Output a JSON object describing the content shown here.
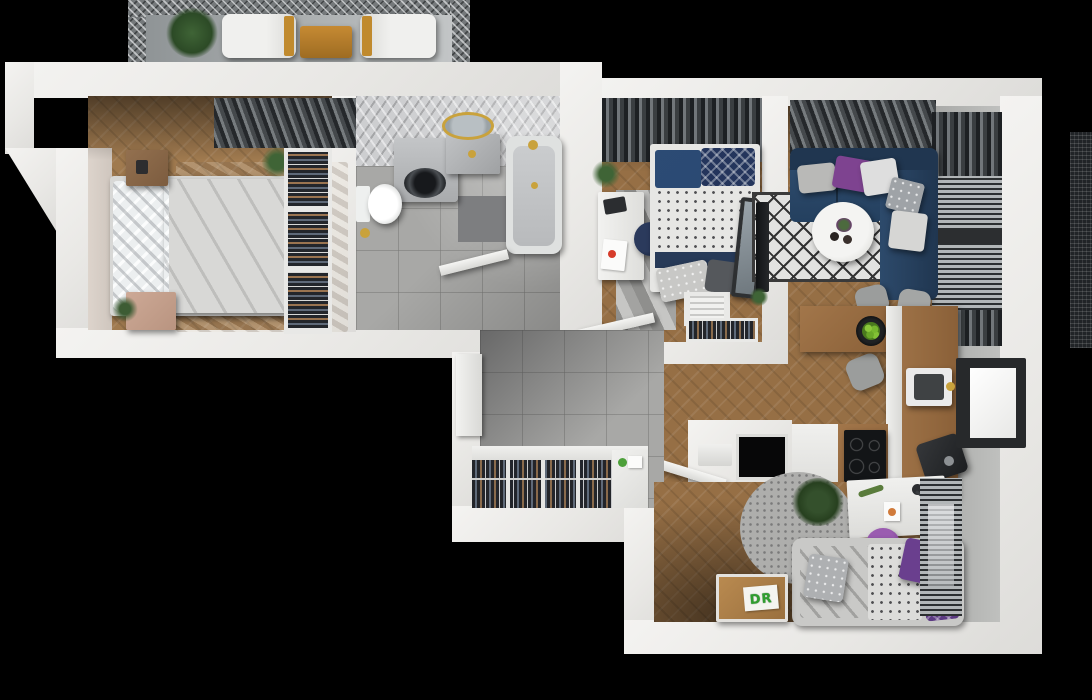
{
  "scene": {
    "description": "Top-down 3D architectural render of a furnished apartment floor plan on a black background",
    "labels": {
      "toy_chest": "DR"
    },
    "palette": {
      "background": "#000000",
      "outer_wall": "#efeeec",
      "wood_floor": "#966f45",
      "tile_floor": "#a8a8a6",
      "bathroom_wall_tile": "#cdced0",
      "master_bed_duvet": "#7e3f90",
      "sofa_navy": "#28415f",
      "accent_pillow_purple": "#7e4390",
      "kids_pillow_purple": "#5c3a82",
      "kids_stool_purple": "#8a4a9e",
      "balcony_table_wood": "#b5792c",
      "nightstand_wood": "#8a6a4e",
      "toy_chest_wood": "#a97c48",
      "apples_green": "#76b72e",
      "gold_fixtures": "#c9a23c",
      "curtain_dark": "#3a3d3f",
      "rug_diamond_black": "#3a3a3a"
    },
    "rooms": [
      {
        "name": "Balcony",
        "items": [
          "mesh railing",
          "potted plant",
          "lounge chair",
          "wooden table",
          "lounge chair"
        ]
      },
      {
        "name": "Master bedroom",
        "items": [
          "double bed with purple duvet",
          "white pillows",
          "wooden nightstand",
          "pink nightstand",
          "beige area rug",
          "open wardrobe with hanging clothes",
          "dark window curtains",
          "potted plant",
          "open door"
        ]
      },
      {
        "name": "Bathroom",
        "items": [
          "bathtub with gold faucet",
          "round gold-framed mirror",
          "stone sink vanity",
          "washing machine",
          "toilet",
          "dark floor mat",
          "herringbone tiled wall",
          "open door"
        ]
      },
      {
        "name": "Small bedroom",
        "items": [
          "single bed with navy and patterned bedding",
          "white desk with laptop and papers",
          "navy stool",
          "chevron rug",
          "shelf with folded towels",
          "clothes rack",
          "leaning mirror",
          "dark window curtains",
          "potted plant",
          "open door"
        ]
      },
      {
        "name": "Living room",
        "items": [
          "navy corner sofa",
          "purple, white and gray throw pillows",
          "round white coffee table",
          "black and white diamond rug",
          "wall-mounted TV",
          "windows with curtains and blinds"
        ]
      },
      {
        "name": "Kitchen and dining",
        "items": [
          "L-shaped wooden counter",
          "sink with gold tap",
          "black induction cooktop",
          "coffee machine",
          "bowl of green apples",
          "four gray chairs",
          "window"
        ]
      },
      {
        "name": "Hallway",
        "items": [
          "gray tile floor",
          "long wardrobe with hanging clothes",
          "white storage cabinet",
          "shoe rack",
          "open entrance door"
        ]
      },
      {
        "name": "Kids room",
        "items": [
          "single bed with gray and purple bedding",
          "round fluffy gray rug",
          "white desk with lamp and toys",
          "purple stool",
          "wooden toy chest with DR sticker",
          "potted plant",
          "window with dark blinds"
        ]
      }
    ]
  }
}
